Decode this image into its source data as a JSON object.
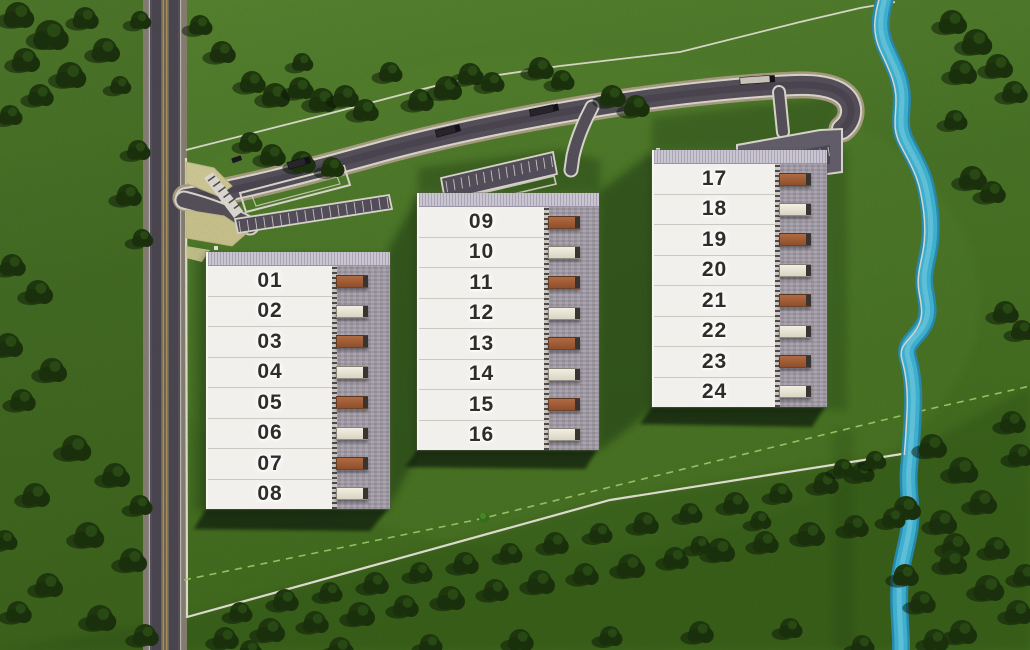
{
  "site": {
    "buildings": [
      {
        "name": "building-1",
        "units": [
          "01",
          "02",
          "03",
          "04",
          "05",
          "06",
          "07",
          "08"
        ]
      },
      {
        "name": "building-2",
        "units": [
          "09",
          "10",
          "11",
          "12",
          "13",
          "14",
          "15",
          "16"
        ]
      },
      {
        "name": "building-3",
        "units": [
          "17",
          "18",
          "19",
          "20",
          "21",
          "22",
          "23",
          "24"
        ]
      }
    ]
  },
  "colors": {
    "grass": "#4e7b2a",
    "grass_light": "#5d8c33",
    "grass_dark": "#3a5f1f",
    "tree": "#223c10",
    "tree_shadow": "#0c1a06",
    "river": "#44bfe1",
    "river_deep": "#2d95ba",
    "river_light": "#6fd3ec",
    "asphalt": "#5b5560",
    "road_shoulder": "#b3a78a",
    "lane_white": "#e9e6da",
    "boundary_white": "#f0eee0",
    "setback_green": "#a6d86e",
    "yellow_line": "#c2a250",
    "entry_island": "#dcd5a0",
    "lot_fill": "#5a5462",
    "lot3_fill": "#6b6573",
    "building_white": "#f1f0ec",
    "roof_edge": "#c6c2cf",
    "dock_concrete": "#a29ca7",
    "truck_orange": "#9c5a35",
    "truck_white": "#e9e5d6",
    "truck_dark": "#2b2830",
    "shadow_dark": "#0e1d07"
  }
}
